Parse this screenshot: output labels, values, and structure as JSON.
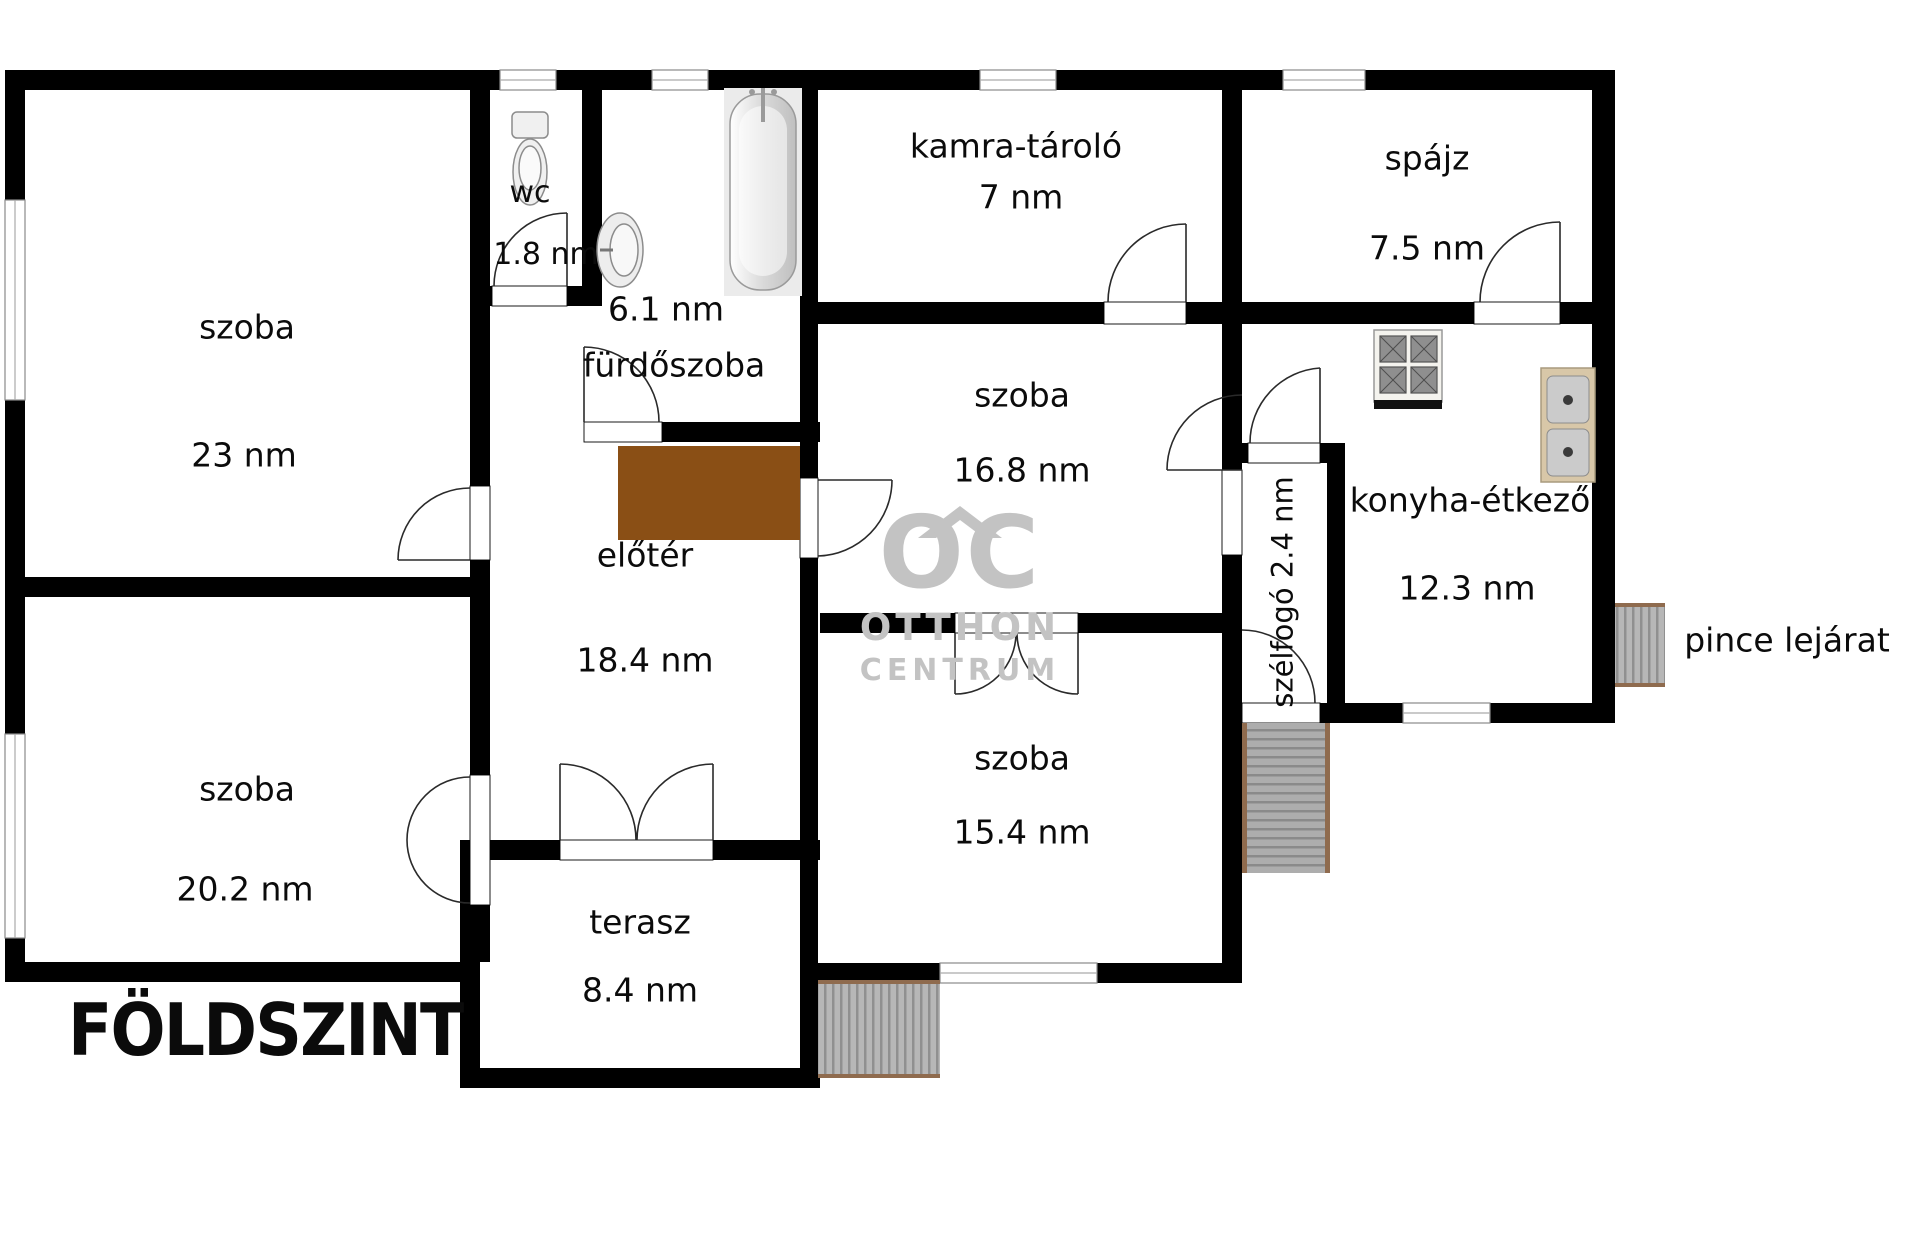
{
  "floor": {
    "title": "FÖLDSZINT"
  },
  "watermark": {
    "logo_text": "OC",
    "line1": "OTTHON",
    "line2": "CENTRUM"
  },
  "outside": {
    "basement_label": "pince lejárat"
  },
  "rooms": {
    "szoba23": {
      "name": "szoba",
      "area": "23 nm"
    },
    "szoba202": {
      "name": "szoba",
      "area": "20.2 nm"
    },
    "wc": {
      "name": "wc",
      "area": "1.8 nm"
    },
    "furdoszoba": {
      "name": "fürdőszoba",
      "area": "6.1 nm"
    },
    "eloter": {
      "name": "előtér",
      "area": "18.4 nm"
    },
    "terasz": {
      "name": "terasz",
      "area": "8.4 nm"
    },
    "kamra": {
      "name": "kamra-tároló",
      "area": "7 nm"
    },
    "szoba168": {
      "name": "szoba",
      "area": "16.8 nm"
    },
    "szoba154": {
      "name": "szoba",
      "area": "15.4 nm"
    },
    "spajz": {
      "name": "spájz",
      "area": "7.5 nm"
    },
    "konyha": {
      "name": "konyha-étkező",
      "area": "12.3 nm"
    },
    "szelfogo": {
      "label": "szélfogó 2.4 nm"
    }
  },
  "colors": {
    "wall": "#000000",
    "cabinet": "#8a4f15",
    "stair_fill": "#b5b5b5",
    "stair_edge": "#8f6b4e",
    "watermark": "#c3c3c3",
    "fixture_fill": "#f0f0f0",
    "fixture_stroke": "#8c8c8c"
  }
}
